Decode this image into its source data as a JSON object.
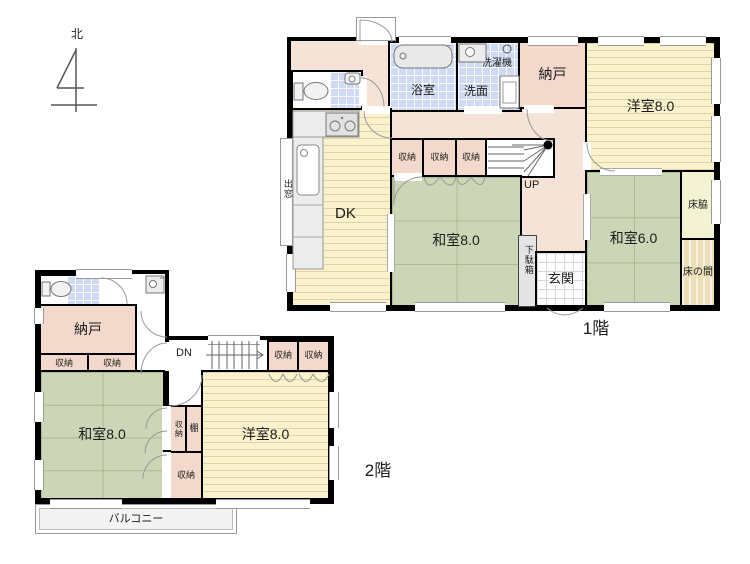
{
  "compass": {
    "north_label": "北"
  },
  "floor1": {
    "caption": "1階",
    "bathroom_label": "浴室",
    "washroom_label": "洗面",
    "washing_machine_label": "洗濯機",
    "storage_label": "納戸",
    "western_room_label": "洋室8.0",
    "dk_label": "DK",
    "bay_window_label": "出窓",
    "closet1_label": "収納",
    "closet2_label": "収納",
    "closet3_label": "収納",
    "stairs_label": "UP",
    "japanese_room8_label": "和室8.0",
    "shoe_cabinet_label": "下駄箱",
    "entrance_label": "玄関",
    "japanese_room6_label": "和室6.0",
    "tokowaki_label": "床脇",
    "tokonoma_label": "床の間"
  },
  "floor2": {
    "caption": "2階",
    "storage_label": "納戸",
    "closet_a_label": "収納",
    "closet_b_label": "収納",
    "stairs_label": "DN",
    "closet_c_label": "収納",
    "closet_d_label": "収納",
    "japanese_room8_label": "和室8.0",
    "closet_mid_label": "収納",
    "shelf_label": "棚",
    "closet_bottom_label": "収納",
    "western_room_label": "洋室8.0",
    "balcony_label": "バルコニー"
  },
  "colors": {
    "wall": "#000000",
    "tatami": "#ccd6b6",
    "flooring": "#faf2cd",
    "hallway": "#f6e3d8",
    "closet": "#f2d9cb",
    "tile_blue": "#cfdbf2",
    "balcony": "#f3f3f3"
  }
}
